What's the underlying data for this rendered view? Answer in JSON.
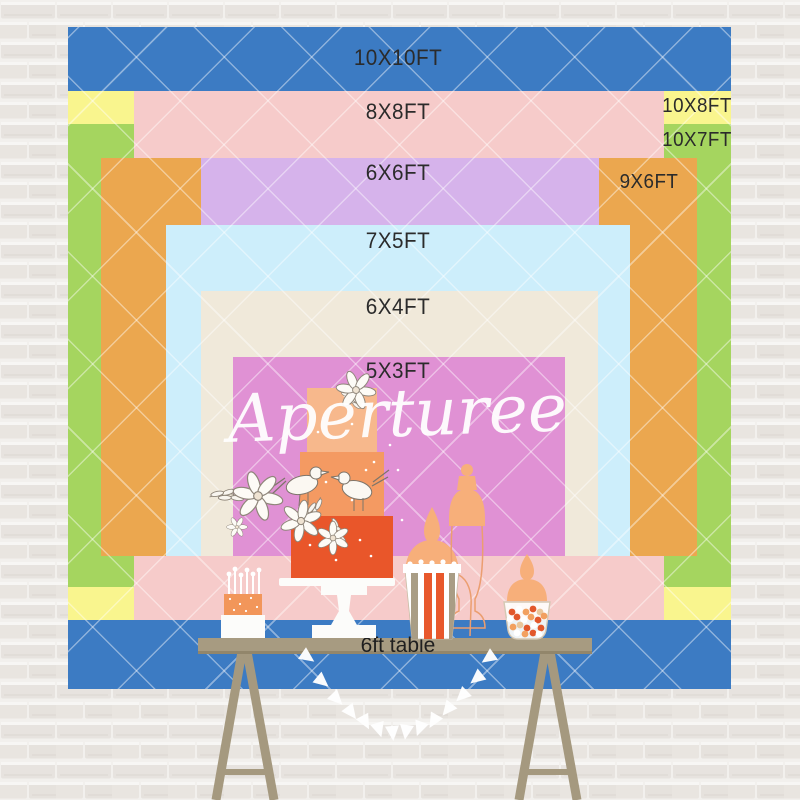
{
  "watermark": "Aperturee",
  "backdrop_sizes": [
    {
      "label": "10X10FT",
      "width_ft": 10,
      "height_ft": 10,
      "color": "#3c7bc3"
    },
    {
      "label": "10X8FT",
      "width_ft": 10,
      "height_ft": 8,
      "color": "#f9f58e"
    },
    {
      "label": "10X7FT",
      "width_ft": 10,
      "height_ft": 7,
      "color": "#a5d55f"
    },
    {
      "label": "8X8FT",
      "width_ft": 8,
      "height_ft": 8,
      "color": "#f6cbca"
    },
    {
      "label": "9X6FT",
      "width_ft": 9,
      "height_ft": 6,
      "color": "#eba74f"
    },
    {
      "label": "6X6FT",
      "width_ft": 6,
      "height_ft": 6,
      "color": "#d6b3eb"
    },
    {
      "label": "7X5FT",
      "width_ft": 7,
      "height_ft": 5,
      "color": "#cdeefb"
    },
    {
      "label": "6X4FT",
      "width_ft": 6,
      "height_ft": 4,
      "color": "#f0e9da"
    },
    {
      "label": "5X3FT",
      "width_ft": 5,
      "height_ft": 3,
      "color": "#e091d4"
    }
  ],
  "table": {
    "label": "6ft table",
    "color": "#a79b81"
  },
  "colors": {
    "wall": "#ebe8e5",
    "label_text": "#2b2b2b",
    "cake_red": "#e9562a",
    "cake_orange": "#f49a62",
    "cake_peach": "#f7b88c",
    "jar_peach": "#f7af7a",
    "watermark_white": "#ffffff"
  }
}
